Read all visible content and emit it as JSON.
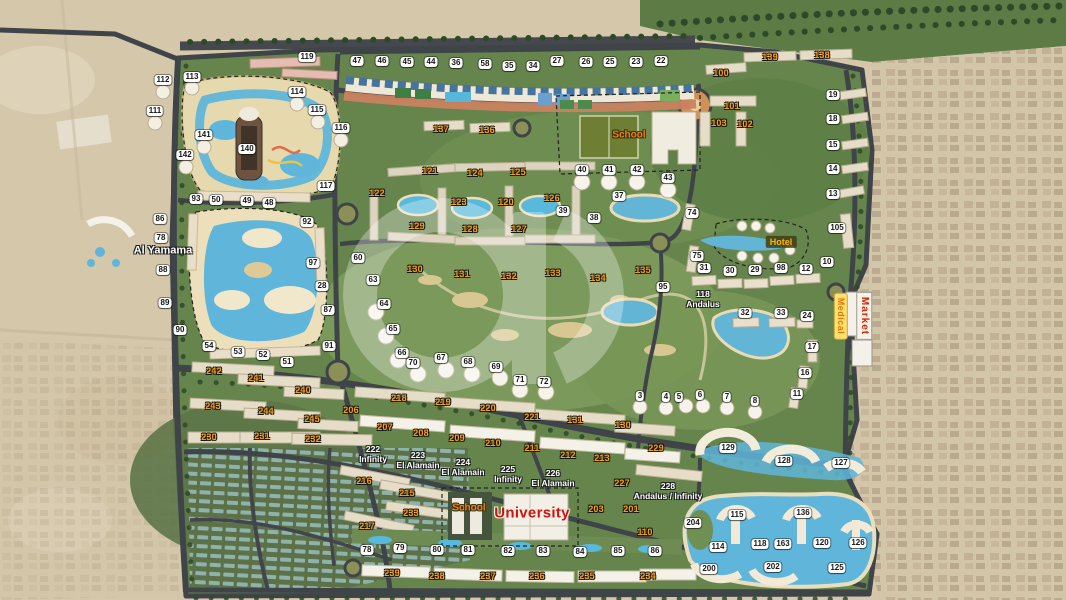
{
  "map": {
    "colors": {
      "desert": "#d5c8aa",
      "plan_green": "#66854d",
      "golf_green": "#7b9a5c",
      "water": "#5fb6da",
      "road": "#3f4449",
      "sand_rim": "#ecdfba",
      "badge_white_bg": "#ffffff",
      "badge_white_text": "#151515",
      "badge_orange": "#ff9d00",
      "university_red": "#d01212",
      "market_red": "#d42200",
      "medical_orange": "#e07900",
      "hotel_amber": "#ffb400"
    },
    "zone_labels": [
      {
        "text": "School",
        "x": 629,
        "y": 135,
        "kind": "school"
      },
      {
        "text": "School",
        "x": 469,
        "y": 508,
        "kind": "school"
      },
      {
        "text": "University",
        "x": 532,
        "y": 513,
        "kind": "university"
      },
      {
        "text": "Hotel",
        "x": 781,
        "y": 242,
        "kind": "hotel"
      },
      {
        "text": "Market",
        "x": 864,
        "y": 316,
        "kind": "market"
      },
      {
        "text": "Medical",
        "x": 841,
        "y": 316,
        "kind": "medical"
      },
      {
        "text": "Al Yamama",
        "x": 163,
        "y": 251,
        "kind": "area"
      },
      {
        "text": "118\nAndalus",
        "x": 703,
        "y": 300,
        "kind": "area-sm"
      },
      {
        "text": "222\nInfinity",
        "x": 373,
        "y": 455,
        "kind": "area-sm"
      },
      {
        "text": "223\nEl Alamain",
        "x": 418,
        "y": 461,
        "kind": "area-sm"
      },
      {
        "text": "224\nEl Alamain",
        "x": 463,
        "y": 468,
        "kind": "area-sm"
      },
      {
        "text": "225\nInfinity",
        "x": 508,
        "y": 475,
        "kind": "area-sm"
      },
      {
        "text": "226\nEl Alamain",
        "x": 553,
        "y": 479,
        "kind": "area-sm"
      },
      {
        "text": "228\nAndalus / Infinity",
        "x": 668,
        "y": 492,
        "kind": "area-sm"
      }
    ],
    "white_badges": [
      {
        "n": "47",
        "x": 357,
        "y": 61
      },
      {
        "n": "46",
        "x": 382,
        "y": 61
      },
      {
        "n": "45",
        "x": 407,
        "y": 62
      },
      {
        "n": "44",
        "x": 431,
        "y": 62
      },
      {
        "n": "36",
        "x": 456,
        "y": 63
      },
      {
        "n": "58",
        "x": 485,
        "y": 64
      },
      {
        "n": "35",
        "x": 509,
        "y": 66
      },
      {
        "n": "34",
        "x": 533,
        "y": 66
      },
      {
        "n": "27",
        "x": 557,
        "y": 61
      },
      {
        "n": "26",
        "x": 586,
        "y": 62
      },
      {
        "n": "25",
        "x": 610,
        "y": 62
      },
      {
        "n": "23",
        "x": 636,
        "y": 62
      },
      {
        "n": "22",
        "x": 661,
        "y": 61
      },
      {
        "n": "119",
        "x": 307,
        "y": 57
      },
      {
        "n": "112",
        "x": 163,
        "y": 80
      },
      {
        "n": "113",
        "x": 192,
        "y": 77
      },
      {
        "n": "111",
        "x": 155,
        "y": 111
      },
      {
        "n": "114",
        "x": 297,
        "y": 92
      },
      {
        "n": "115",
        "x": 317,
        "y": 110
      },
      {
        "n": "116",
        "x": 341,
        "y": 128
      },
      {
        "n": "141",
        "x": 204,
        "y": 135
      },
      {
        "n": "142",
        "x": 185,
        "y": 155
      },
      {
        "n": "140",
        "x": 247,
        "y": 149
      },
      {
        "n": "117",
        "x": 326,
        "y": 186
      },
      {
        "n": "93",
        "x": 196,
        "y": 199
      },
      {
        "n": "50",
        "x": 216,
        "y": 200
      },
      {
        "n": "49",
        "x": 247,
        "y": 201
      },
      {
        "n": "48",
        "x": 269,
        "y": 203
      },
      {
        "n": "92",
        "x": 307,
        "y": 222
      },
      {
        "n": "86",
        "x": 160,
        "y": 219
      },
      {
        "n": "78",
        "x": 161,
        "y": 238
      },
      {
        "n": "88",
        "x": 163,
        "y": 270
      },
      {
        "n": "89",
        "x": 165,
        "y": 303
      },
      {
        "n": "90",
        "x": 180,
        "y": 330
      },
      {
        "n": "97",
        "x": 313,
        "y": 263
      },
      {
        "n": "28",
        "x": 322,
        "y": 286
      },
      {
        "n": "87",
        "x": 328,
        "y": 310
      },
      {
        "n": "91",
        "x": 329,
        "y": 346
      },
      {
        "n": "54",
        "x": 209,
        "y": 346
      },
      {
        "n": "53",
        "x": 238,
        "y": 352
      },
      {
        "n": "52",
        "x": 263,
        "y": 355
      },
      {
        "n": "51",
        "x": 287,
        "y": 362
      },
      {
        "n": "60",
        "x": 358,
        "y": 258
      },
      {
        "n": "63",
        "x": 373,
        "y": 280
      },
      {
        "n": "64",
        "x": 384,
        "y": 304
      },
      {
        "n": "65",
        "x": 393,
        "y": 329
      },
      {
        "n": "66",
        "x": 402,
        "y": 353
      },
      {
        "n": "70",
        "x": 413,
        "y": 363
      },
      {
        "n": "67",
        "x": 441,
        "y": 358
      },
      {
        "n": "68",
        "x": 468,
        "y": 362
      },
      {
        "n": "69",
        "x": 496,
        "y": 367
      },
      {
        "n": "40",
        "x": 582,
        "y": 170
      },
      {
        "n": "41",
        "x": 609,
        "y": 170
      },
      {
        "n": "42",
        "x": 637,
        "y": 170
      },
      {
        "n": "43",
        "x": 668,
        "y": 178
      },
      {
        "n": "39",
        "x": 563,
        "y": 211
      },
      {
        "n": "38",
        "x": 594,
        "y": 218
      },
      {
        "n": "37",
        "x": 619,
        "y": 196
      },
      {
        "n": "74",
        "x": 692,
        "y": 213
      },
      {
        "n": "75",
        "x": 697,
        "y": 256
      },
      {
        "n": "31",
        "x": 704,
        "y": 268
      },
      {
        "n": "30",
        "x": 730,
        "y": 271
      },
      {
        "n": "29",
        "x": 755,
        "y": 270
      },
      {
        "n": "98",
        "x": 781,
        "y": 268
      },
      {
        "n": "12",
        "x": 806,
        "y": 269
      },
      {
        "n": "10",
        "x": 827,
        "y": 262
      },
      {
        "n": "13",
        "x": 833,
        "y": 194
      },
      {
        "n": "105",
        "x": 837,
        "y": 228
      },
      {
        "n": "19",
        "x": 833,
        "y": 95
      },
      {
        "n": "18",
        "x": 833,
        "y": 119
      },
      {
        "n": "15",
        "x": 833,
        "y": 145
      },
      {
        "n": "14",
        "x": 833,
        "y": 169
      },
      {
        "n": "95",
        "x": 663,
        "y": 287
      },
      {
        "n": "32",
        "x": 745,
        "y": 313
      },
      {
        "n": "33",
        "x": 781,
        "y": 313
      },
      {
        "n": "24",
        "x": 807,
        "y": 316
      },
      {
        "n": "17",
        "x": 812,
        "y": 347
      },
      {
        "n": "16",
        "x": 805,
        "y": 373
      },
      {
        "n": "11",
        "x": 797,
        "y": 394
      },
      {
        "n": "3",
        "x": 640,
        "y": 396
      },
      {
        "n": "4",
        "x": 666,
        "y": 397
      },
      {
        "n": "5",
        "x": 679,
        "y": 397
      },
      {
        "n": "6",
        "x": 700,
        "y": 395
      },
      {
        "n": "7",
        "x": 727,
        "y": 397
      },
      {
        "n": "8",
        "x": 755,
        "y": 401
      },
      {
        "n": "71",
        "x": 520,
        "y": 380
      },
      {
        "n": "72",
        "x": 544,
        "y": 382
      },
      {
        "n": "78",
        "x": 367,
        "y": 550
      },
      {
        "n": "79",
        "x": 400,
        "y": 548
      },
      {
        "n": "80",
        "x": 437,
        "y": 550
      },
      {
        "n": "81",
        "x": 468,
        "y": 550
      },
      {
        "n": "82",
        "x": 508,
        "y": 551
      },
      {
        "n": "83",
        "x": 543,
        "y": 551
      },
      {
        "n": "84",
        "x": 580,
        "y": 552
      },
      {
        "n": "85",
        "x": 618,
        "y": 551
      },
      {
        "n": "86",
        "x": 655,
        "y": 551
      },
      {
        "n": "127",
        "x": 841,
        "y": 463
      },
      {
        "n": "128",
        "x": 784,
        "y": 461
      },
      {
        "n": "129",
        "x": 728,
        "y": 448
      },
      {
        "n": "204",
        "x": 693,
        "y": 523
      },
      {
        "n": "115",
        "x": 737,
        "y": 515
      },
      {
        "n": "136",
        "x": 803,
        "y": 513
      },
      {
        "n": "114",
        "x": 718,
        "y": 547
      },
      {
        "n": "118",
        "x": 760,
        "y": 544
      },
      {
        "n": "163",
        "x": 783,
        "y": 544
      },
      {
        "n": "120",
        "x": 822,
        "y": 543
      },
      {
        "n": "126",
        "x": 858,
        "y": 543
      },
      {
        "n": "200",
        "x": 709,
        "y": 569
      },
      {
        "n": "202",
        "x": 773,
        "y": 567
      },
      {
        "n": "125",
        "x": 837,
        "y": 568
      }
    ],
    "orange_badges": [
      {
        "n": "139",
        "x": 770,
        "y": 57
      },
      {
        "n": "138",
        "x": 822,
        "y": 55
      },
      {
        "n": "100",
        "x": 721,
        "y": 73
      },
      {
        "n": "101",
        "x": 732,
        "y": 106
      },
      {
        "n": "103",
        "x": 719,
        "y": 123
      },
      {
        "n": "102",
        "x": 745,
        "y": 124
      },
      {
        "n": "137",
        "x": 441,
        "y": 129
      },
      {
        "n": "136",
        "x": 487,
        "y": 130
      },
      {
        "n": "122",
        "x": 377,
        "y": 193
      },
      {
        "n": "121",
        "x": 430,
        "y": 171
      },
      {
        "n": "124",
        "x": 475,
        "y": 173
      },
      {
        "n": "125",
        "x": 518,
        "y": 172
      },
      {
        "n": "123",
        "x": 459,
        "y": 202
      },
      {
        "n": "120",
        "x": 506,
        "y": 202
      },
      {
        "n": "126",
        "x": 552,
        "y": 198
      },
      {
        "n": "129",
        "x": 417,
        "y": 226
      },
      {
        "n": "128",
        "x": 470,
        "y": 229
      },
      {
        "n": "127",
        "x": 519,
        "y": 229
      },
      {
        "n": "130",
        "x": 415,
        "y": 269
      },
      {
        "n": "131",
        "x": 462,
        "y": 274
      },
      {
        "n": "132",
        "x": 509,
        "y": 276
      },
      {
        "n": "133",
        "x": 553,
        "y": 273
      },
      {
        "n": "134",
        "x": 598,
        "y": 278
      },
      {
        "n": "135",
        "x": 643,
        "y": 270
      },
      {
        "n": "242",
        "x": 214,
        "y": 371
      },
      {
        "n": "241",
        "x": 256,
        "y": 378
      },
      {
        "n": "240",
        "x": 303,
        "y": 390
      },
      {
        "n": "243",
        "x": 213,
        "y": 406
      },
      {
        "n": "244",
        "x": 266,
        "y": 411
      },
      {
        "n": "245",
        "x": 312,
        "y": 419
      },
      {
        "n": "206",
        "x": 351,
        "y": 410
      },
      {
        "n": "207",
        "x": 385,
        "y": 427
      },
      {
        "n": "230",
        "x": 209,
        "y": 437
      },
      {
        "n": "231",
        "x": 262,
        "y": 436
      },
      {
        "n": "232",
        "x": 313,
        "y": 439
      },
      {
        "n": "218",
        "x": 399,
        "y": 398
      },
      {
        "n": "219",
        "x": 443,
        "y": 402
      },
      {
        "n": "220",
        "x": 488,
        "y": 408
      },
      {
        "n": "221",
        "x": 532,
        "y": 417
      },
      {
        "n": "131",
        "x": 575,
        "y": 420
      },
      {
        "n": "208",
        "x": 421,
        "y": 433
      },
      {
        "n": "209",
        "x": 457,
        "y": 438
      },
      {
        "n": "210",
        "x": 493,
        "y": 443
      },
      {
        "n": "211",
        "x": 532,
        "y": 448
      },
      {
        "n": "212",
        "x": 568,
        "y": 455
      },
      {
        "n": "213",
        "x": 602,
        "y": 458
      },
      {
        "n": "130",
        "x": 623,
        "y": 425
      },
      {
        "n": "229",
        "x": 656,
        "y": 448
      },
      {
        "n": "227",
        "x": 622,
        "y": 483
      },
      {
        "n": "216",
        "x": 364,
        "y": 481
      },
      {
        "n": "215",
        "x": 407,
        "y": 493
      },
      {
        "n": "233",
        "x": 411,
        "y": 513
      },
      {
        "n": "217",
        "x": 367,
        "y": 526
      },
      {
        "n": "203",
        "x": 596,
        "y": 509
      },
      {
        "n": "201",
        "x": 631,
        "y": 509
      },
      {
        "n": "110",
        "x": 645,
        "y": 532
      },
      {
        "n": "239",
        "x": 392,
        "y": 573
      },
      {
        "n": "238",
        "x": 437,
        "y": 576
      },
      {
        "n": "237",
        "x": 488,
        "y": 576
      },
      {
        "n": "236",
        "x": 537,
        "y": 576
      },
      {
        "n": "235",
        "x": 587,
        "y": 576
      },
      {
        "n": "234",
        "x": 648,
        "y": 576
      }
    ]
  }
}
